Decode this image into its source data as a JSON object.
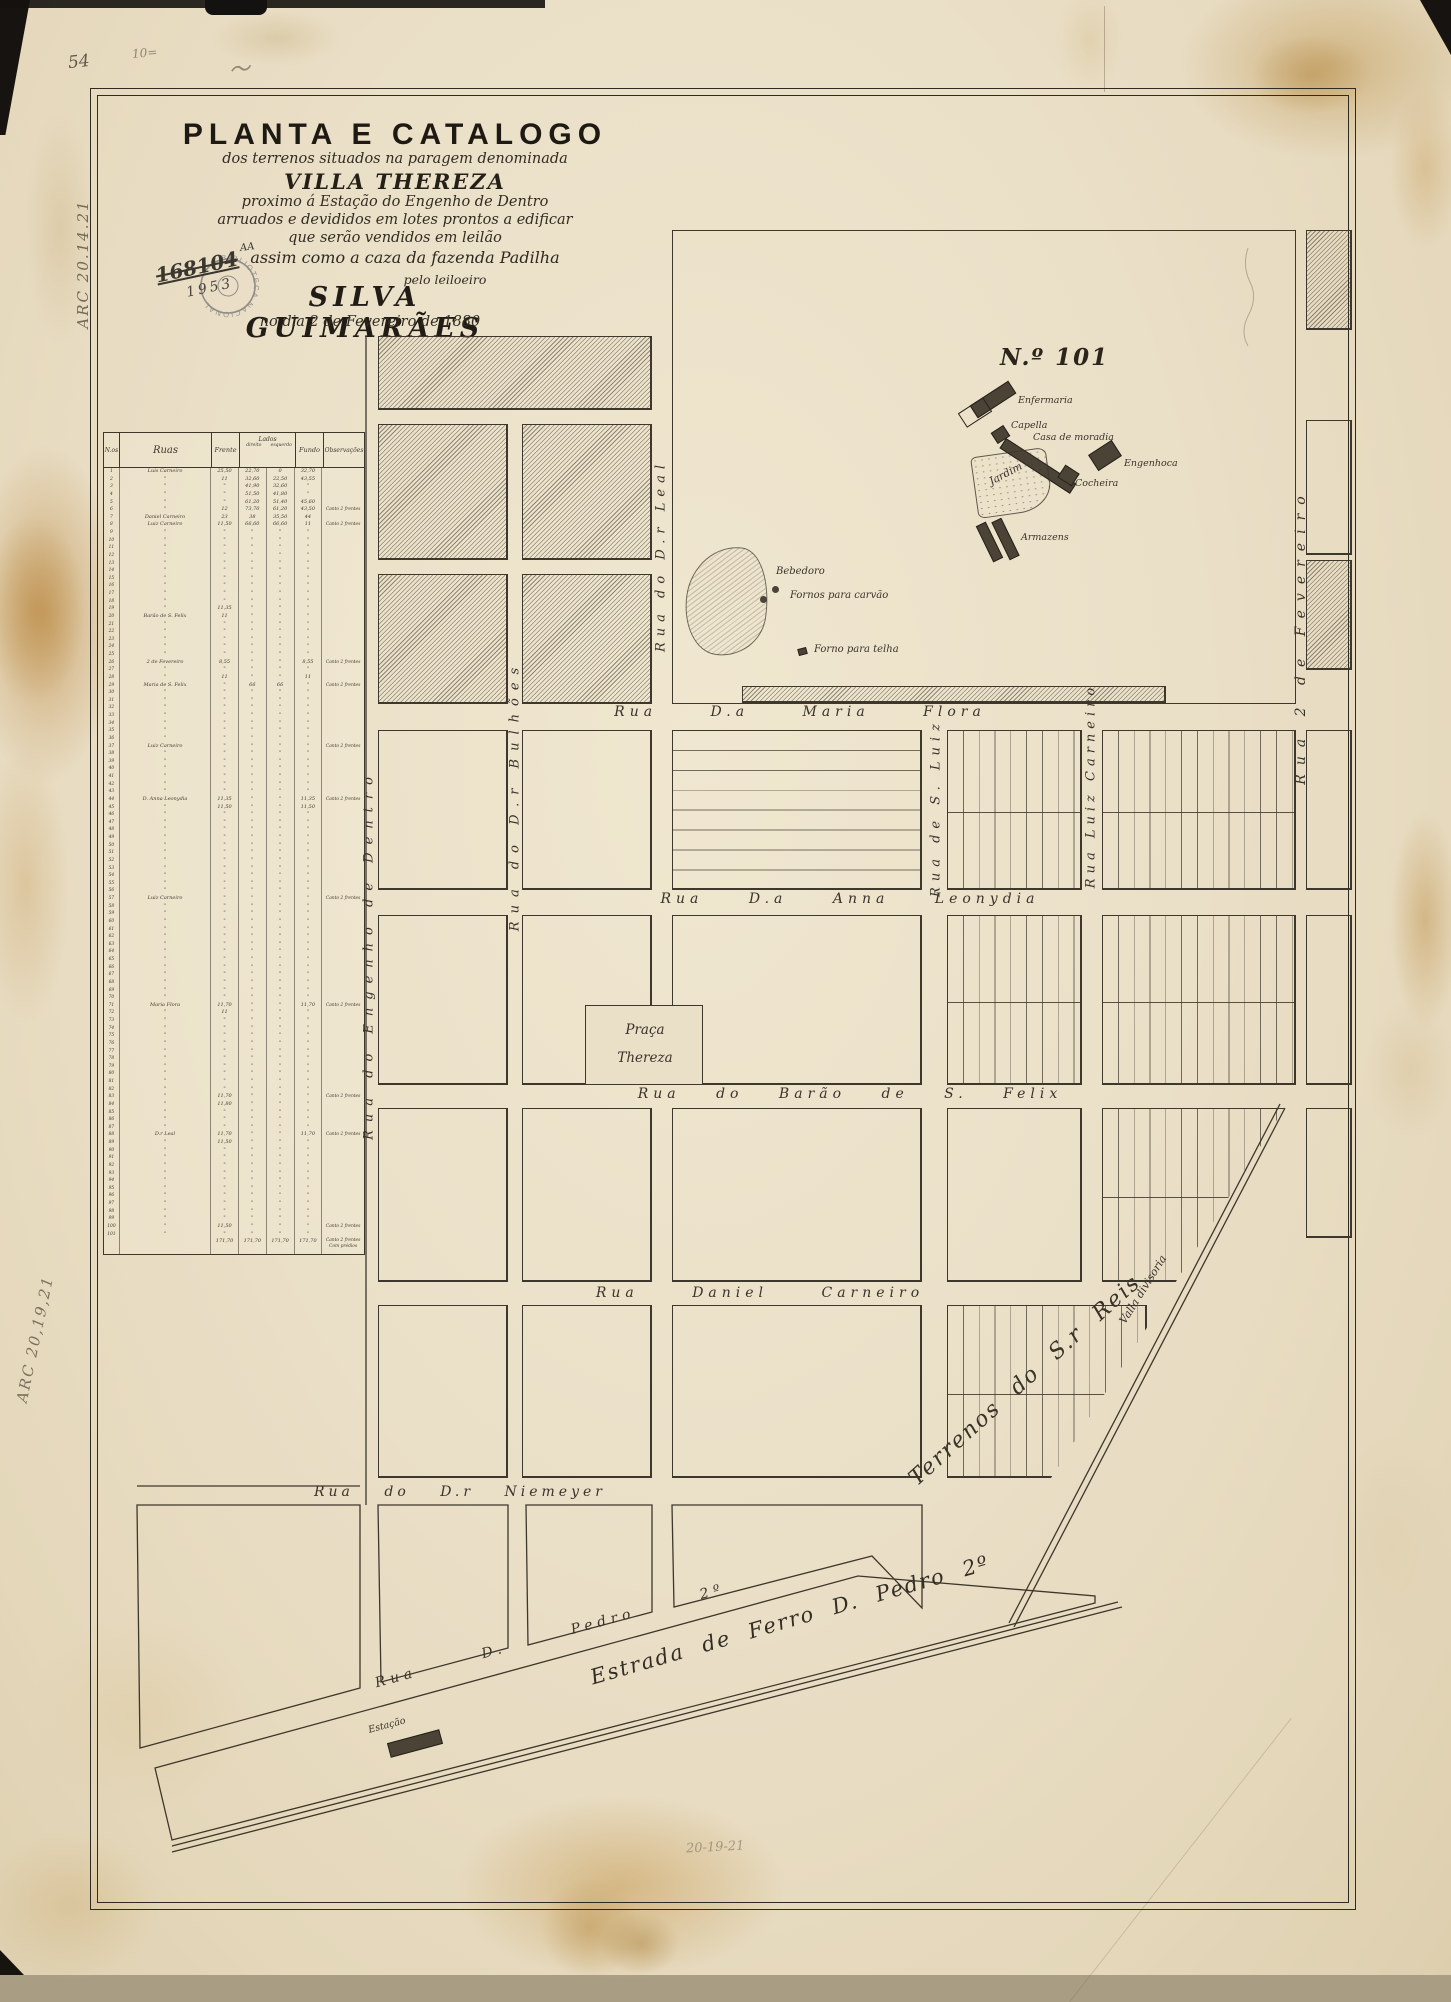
{
  "annotations": {
    "page_number": "54",
    "pencil_top": "10=",
    "pencil_squiggle": "〜",
    "call_number_top": "ARC 20.14.21",
    "call_number_bottom": "ARC 20,19,21",
    "pencil_bottom": "20-19-21",
    "stamp_text": "BIBLIOTECA NACIONAL",
    "stamp_number": "168104",
    "stamp_number_suffix": "AA",
    "stamp_year": "1953"
  },
  "title_block": {
    "line1": "PLANTA E CATALOGO",
    "line2": "dos terrenos situados na paragem denominada",
    "line3": "VILLA THEREZA",
    "line4": "proximo á Estação do Engenho de Dentro",
    "line5": "arruados e devididos em lotes prontos a edificar",
    "line6": "que serão vendidos em leilão",
    "line7": "assim como a caza da fazenda Padilha",
    "line8": "pelo leiloeiro",
    "line9": "SILVA GUIMARÃES",
    "line10": "no dia 2 de Fevereiro de 1880"
  },
  "table": {
    "headers": {
      "no": "N.os",
      "ruas": "Ruas",
      "frente": "Frente",
      "lados": "Lados",
      "lados_d": "direito",
      "lados_e": "esquerdo",
      "fundo": "Fundo",
      "obs": "Observações"
    },
    "row_count": 101,
    "default_mark": "\"",
    "marked_rows": {
      "1": {
        "rua": "Luis Carneiro",
        "f": "25,50",
        "ld": "22,70",
        "le": "0",
        "fu": "32,70"
      },
      "2": {
        "f": "11",
        "ld": "32,60",
        "le": "22,50",
        "fu": "43,55"
      },
      "3": {
        "ld": "41,90",
        "le": "32,60"
      },
      "4": {
        "ld": "51,50",
        "le": "41,80"
      },
      "5": {
        "ld": "61,20",
        "le": "51,40",
        "fu": "45,60"
      },
      "6": {
        "f": "12",
        "ld": "73,70",
        "le": "61,20",
        "fu": "43,50",
        "o": "Canto 2 frentes"
      },
      "7": {
        "rua": "Daniel Carneiro",
        "f": "23",
        "ld": "38",
        "le": "35,50",
        "fu": "44"
      },
      "8": {
        "rua": "Luiz Carneiro",
        "f": "11,50",
        "ld": "66,60",
        "le": "66,60",
        "fu": "11",
        "o": "Canto 2 frentes"
      },
      "19": {
        "f": "11,35"
      },
      "20": {
        "rua": "Barão de S. Felix",
        "f": "11"
      },
      "26": {
        "rua": "2 de Fevereiro",
        "f": "8,55",
        "fu": "8,55",
        "o": "Canto 2 frentes"
      },
      "28": {
        "f": "11",
        "fu": "11"
      },
      "29": {
        "rua": "Maria de S. Felix",
        "ld": "66",
        "le": "66",
        "o": "Canto 2 frentes"
      },
      "37": {
        "rua": "Luiz Carneiro",
        "o": "Canto 2 frentes"
      },
      "44": {
        "rua": "D. Anna Leonydia",
        "f": "11,35",
        "fu": "11,35",
        "o": "Canto 2 frentes"
      },
      "45": {
        "f": "11,50",
        "fu": "11,50"
      },
      "57": {
        "rua": "Luiz Carneiro",
        "o": "Canto 2 frentes"
      },
      "71": {
        "rua": "Maria Flora",
        "f": "11,70",
        "fu": "11,70",
        "o": "Canto 2 frentes"
      },
      "72": {
        "f": "11"
      },
      "83": {
        "f": "11,70",
        "o": "Canto 2 frentes"
      },
      "84": {
        "f": "11,80"
      },
      "88": {
        "rua": "D.r Leal",
        "f": "11,70",
        "fu": "11,70",
        "o": "Canto 2 frentes"
      },
      "89": {
        "f": "11,50"
      },
      "100": {
        "f": "11,50",
        "o": "Canto 2 frentes"
      }
    },
    "totals": {
      "f": "171,70",
      "ld": "171,70",
      "le": "171,70",
      "fu": "171,70",
      "o": "Canto 2 frentes Com prédios"
    }
  },
  "map": {
    "estate": {
      "title": "N.º 101",
      "enfermaria": "Enfermaria",
      "capella": "Capella",
      "casa": "Casa de moradia",
      "engenhoca": "Engenhoca",
      "cocheira": "Cocheira",
      "jardim": "Jardim",
      "armazens": "Armazens",
      "bebedoro": "Bebedoro",
      "fornos_carvao": "Fornos para carvão",
      "forno_telha": "Forno para telha"
    },
    "streets": {
      "maria_flora": "Rua D.a Maria Flora",
      "anna_leonydia": "Rua D.a Anna Leonydia",
      "barao_s_felix": "Rua do Barão de S. Felix",
      "daniel_carneiro": "Rua Daniel Carneiro",
      "niemeyer": "Rua do D.r Niemeyer",
      "pedro_segundo": "Rua D. Pedro 2º",
      "engenho_dentro": "Rua do Engenho de Dentro",
      "bulhoes": "Rua do D.r Bulhões",
      "leal": "Rua do D.r Leal",
      "s_luiz": "Rua de S. Luiz",
      "luiz_carneiro": "Rua Luiz Carneiro",
      "fevereiro": "Rua 2 de Fevereiro"
    },
    "praca": {
      "line1": "Praça",
      "line2": "Thereza"
    },
    "railroad": "Estrada de Ferro D. Pedro 2º",
    "station": "Estação",
    "valla": "Valla divisoria",
    "terrenos": "Terrenos do S.r Reis"
  }
}
